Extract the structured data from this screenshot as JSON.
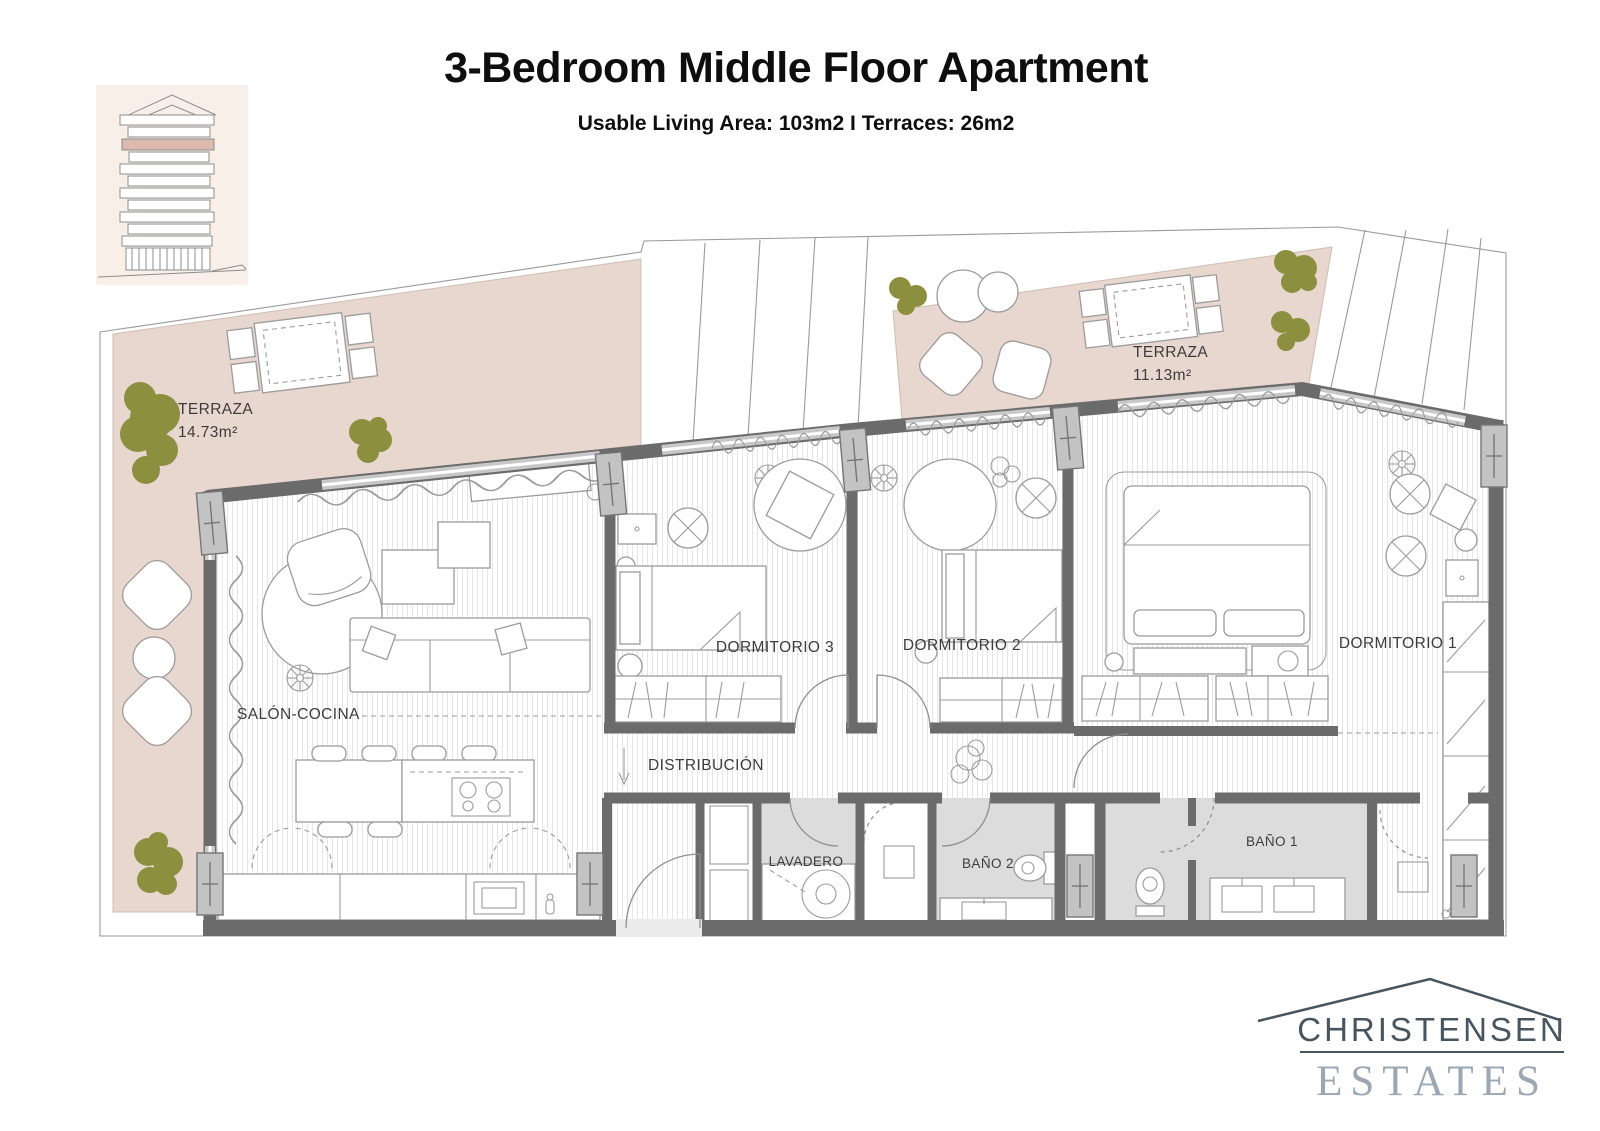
{
  "header": {
    "title": "3-Bedroom Middle Floor Apartment",
    "subtitle": "Usable Living Area: 103m2 I Terraces: 26m2"
  },
  "plan": {
    "terrace_left": {
      "name": "TERRAZA",
      "area": "14.73m²"
    },
    "terrace_right": {
      "name": "TERRAZA",
      "area": "11.13m²"
    },
    "rooms": {
      "salon": "SALÓN-COCINA",
      "distribucion": "DISTRIBUCIÓN",
      "dorm3": "DORMITORIO 3",
      "dorm2": "DORMITORIO 2",
      "dorm1": "DORMITORIO 1",
      "lavadero": "LAVADERO",
      "bano2": "BAÑO 2",
      "bano1": "BAÑO 1"
    }
  },
  "logo": {
    "name": "CHRISTENSEN",
    "type": "ESTATES"
  },
  "theme": {
    "terrace": "#e8d7cf",
    "wall": "#6b6b6b",
    "bath": "#dcdcdc",
    "tree": "#8b8f3e",
    "outline": "#9a9a9a",
    "furniture": "#9b9b9b",
    "label": "#3c3c3c",
    "floor_line": "#e6e6e6",
    "logo_dark": "#46555f",
    "logo_light": "#9ba7b4",
    "thumb_bg": "#f7efe8",
    "thumb_accent": "#ddb9ae"
  }
}
